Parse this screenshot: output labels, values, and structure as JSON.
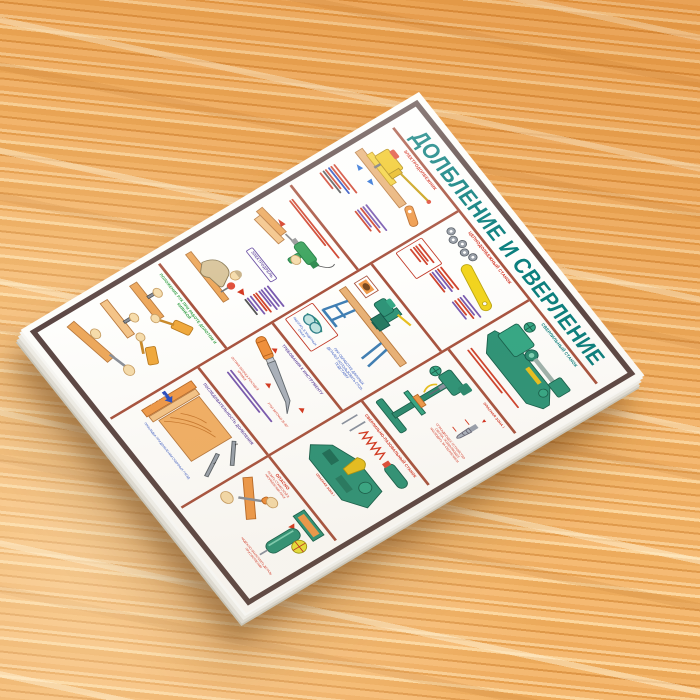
{
  "photo": {
    "subject": "woodworking safety wall chart lying on a wooden table",
    "colors": {
      "table_wood": [
        "#f3b268",
        "#eca352",
        "#f7c88c",
        "#e2933c",
        "#fbd49b",
        "#d98a36"
      ],
      "poster_paper": "#fdfdfa",
      "poster_frame": "#5c4744",
      "panel_divider": "#a85440",
      "title_teal": "#0b7f7e",
      "accent_red": "#d42f1e",
      "accent_purple": "#6a4fa3",
      "accent_blue": "#2b4fc0",
      "accent_green": "#2f9e41",
      "machine_green": "#2e9478",
      "tool_yellow": "#f2c926",
      "wood_orange": "#ef9a4a"
    }
  },
  "poster": {
    "title": "ДОЛБЛЕНИЕ И СВЕРЛЕНИЕ",
    "panels": {
      "electro_mortiser": {
        "heading": "ЭЛЕКТРОДОЛБЕЖНИК"
      },
      "electro_drill": {
        "heading": "ЭЛЕКТРОДРЕЛЬ"
      },
      "hands": {
        "heading": "ПОЛОЖЕНИЕ РУК ПРИ РАБОТЕ ДОЛОТОМ И КИЯНКОЙ"
      },
      "chain_mortiser": {
        "heading": "ЦЕПНОДОЛБЕЖНЫЙ СТАНОК",
        "goggles_caption": "РАБОТАТЬ В ЗАЩИТНЫХ ОЧКАХ",
        "support_note": "ПРИ ОБРАБОТКЕ ДЛИННЫХ ДЕТАЛЕЙ ИСПОЛЬЗОВАТЬ СТОЛ-ПОДСТАВКУ"
      },
      "tool_requirements": {
        "heading": "ТРЕБОВАНИЯ К ИНСТРУМЕНТУ",
        "sharp_note": "ОСТРАЯ ЗАТОЧКА РЕЖУЩЕЙ КРОМКИ",
        "angle_note": "УГОЛ ЗАТОЧКИ 25-30°"
      },
      "sequence": {
        "heading": "ПОСЛЕДОВАТЕЛЬНОСТЬ ДОЛБЛЕНИЯ",
        "bench_label": "ВЕРСТАК",
        "pad_note": "ПРОКЛАДКА ПРИ ДОЛБЛЕНИИ СКВОЗНЫХ ГНЕЗД",
        "step1": "1",
        "step2": "2"
      },
      "drill_machine": {
        "heading": "СВЕРЛИЛЬНЫЙ СТАНОК",
        "danger": "ОПАСНАЯ ЗОНА !",
        "guard_note": "ОГРАЖДАЮЩЕЕ УСТРОЙСТВО СВЕРЛА, ПОЗВОЛЯЮЩЕЕ НАБЛЮДАТЬ ЗА СВЕРЛЕНИЕМ"
      },
      "drill_slot": {
        "heading": "СВЕРЛИЛЬНО-ПАЗОВАЛЬНЫЙ СТАНОК",
        "danger": "ОПАСНАЯ ЗОНА !"
      },
      "danger_chisel": {
        "heading": "ОПАСНО",
        "subheading": "РЕЗАТЬ СТАМЕСКОЙ В НАПРАВЛЕНИИ РУКИ",
        "clamp_note": "НАДЕЖНО ЗАКРЕПЛЯТЬ ДЕТАЛЬ ПРИ СВЕРЛЕНИИ"
      }
    }
  }
}
